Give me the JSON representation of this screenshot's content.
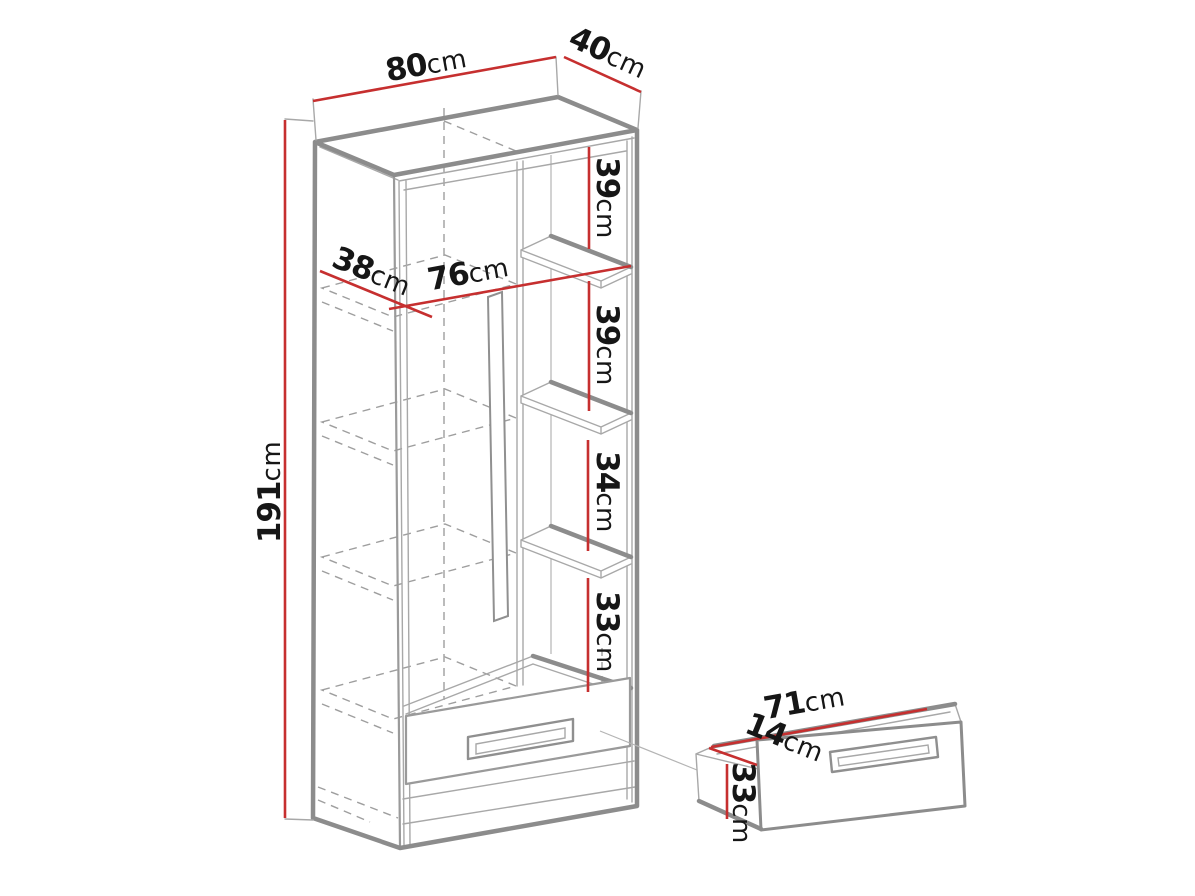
{
  "diagram_type": "furniture-dimension-diagram",
  "colors": {
    "dimension_red": "#c62f2f",
    "outline_gray": "#8c8c8c",
    "background": "#ffffff",
    "label_black": "#161616"
  },
  "cabinet": {
    "overall": {
      "width": {
        "v": "80",
        "u": "cm"
      },
      "depth": {
        "v": "40",
        "u": "cm"
      },
      "height": {
        "v": "191",
        "u": "cm"
      }
    },
    "interior": {
      "width": {
        "v": "76",
        "u": "cm"
      },
      "shelf_depth": {
        "v": "38",
        "u": "cm"
      }
    },
    "shelf_gaps": [
      {
        "v": "39",
        "u": "cm"
      },
      {
        "v": "39",
        "u": "cm"
      },
      {
        "v": "34",
        "u": "cm"
      },
      {
        "v": "33",
        "u": "cm"
      }
    ]
  },
  "drawer_detail": {
    "width": {
      "v": "71",
      "u": "cm"
    },
    "front_height": {
      "v": "14",
      "u": "cm"
    },
    "depth": {
      "v": "33",
      "u": "cm"
    }
  }
}
